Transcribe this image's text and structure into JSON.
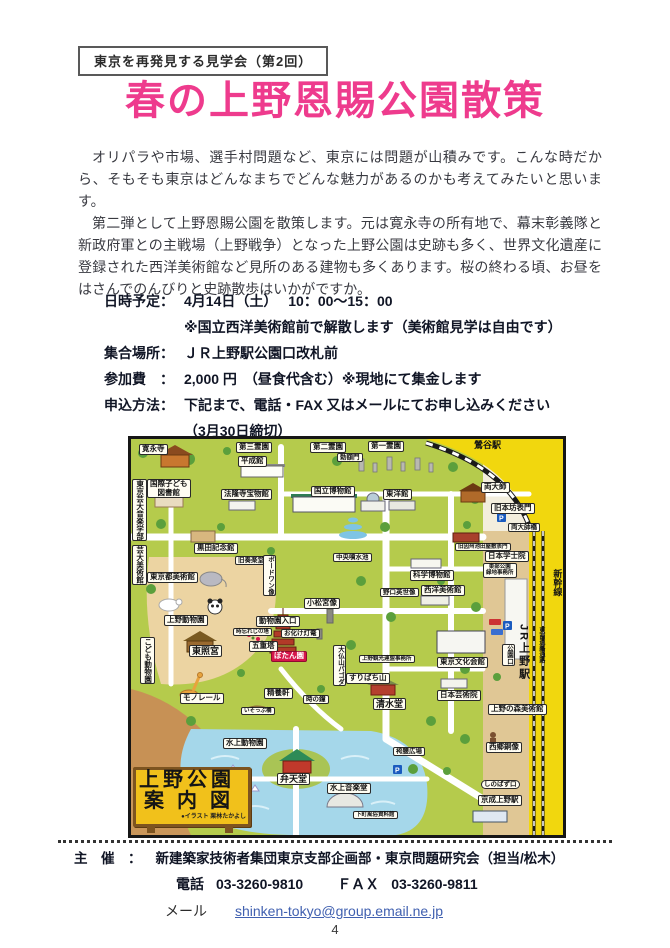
{
  "header": {
    "series_label": "東京を再発見する見学会（第2回）"
  },
  "title": "春の上野恩賜公園散策",
  "intro": {
    "p1": "オリパラや市場、選手村問題など、東京には問題が山積みです。こんな時だから、そもそも東京はどんなまちでどんな魅力があるのかも考えてみたいと思います。",
    "p2": "第二弾として上野恩賜公園を散策します。元は寛永寺の所有地で、幕末彰義隊と新政府軍との主戦場（上野戦争）となった上野公園は史跡も多く、世界文化遺産に登録された西洋美術館など見所のある建物も多くあります。桜の終わる頃、お昼をはさんでのんびりと史跡散歩はいかがですか。"
  },
  "details": {
    "rows": [
      {
        "label": "日時予定：",
        "value": "4月14日（土）　 10：00～15：00",
        "sub": "※国立西洋美術館前で解散します（美術館見学は自由です）"
      },
      {
        "label": "集合場所：",
        "value": "ＪＲ上野駅公園口改札前"
      },
      {
        "label": "参加費　：",
        "value": "2,000 円　（昼食代含む）※現地にて集金します"
      },
      {
        "label": "申込方法：",
        "value": "下記まで、電話・FAX 又はメールにてお申し込みください",
        "sub": "（3月30日締切）"
      }
    ]
  },
  "map": {
    "sign": {
      "line1": "上野公園",
      "line2": "案内図",
      "credit": "●イラスト 栗林たかよし"
    },
    "labels": [
      {
        "t": "寛永寺",
        "x": 8,
        "y": 5
      },
      {
        "t": "第三霊園",
        "x": 105,
        "y": 3
      },
      {
        "t": "第二霊園",
        "x": 179,
        "y": 3
      },
      {
        "t": "第一霊園",
        "x": 237,
        "y": 2
      },
      {
        "t": "鶯谷駅",
        "x": 341,
        "y": 1,
        "s": "plain"
      },
      {
        "t": "平成館",
        "x": 107,
        "y": 17
      },
      {
        "t": "勅額門",
        "x": 206,
        "y": 14,
        "s": "sm"
      },
      {
        "t": "国際子ども\n図書館",
        "x": 16,
        "y": 40
      },
      {
        "t": "法隆寺宝物館",
        "x": 90,
        "y": 50
      },
      {
        "t": "国立博物館",
        "x": 180,
        "y": 47
      },
      {
        "t": "東洋館",
        "x": 252,
        "y": 50
      },
      {
        "t": "両大師",
        "x": 350,
        "y": 43
      },
      {
        "t": "旧本坊表門",
        "x": 360,
        "y": 64
      },
      {
        "t": "両大師橋",
        "x": 377,
        "y": 84,
        "s": "sm"
      },
      {
        "t": "東京芸大音楽学部",
        "x": 1,
        "y": 40,
        "v": 1
      },
      {
        "t": "黒田記念館",
        "x": 63,
        "y": 104
      },
      {
        "t": "旧奏楽堂",
        "x": 104,
        "y": 117,
        "s": "sm"
      },
      {
        "t": "旧因州池田屋敷表門",
        "x": 324,
        "y": 104,
        "s": "tiny"
      },
      {
        "t": "日本学士院",
        "x": 354,
        "y": 112
      },
      {
        "t": "芸大美術館",
        "x": 1,
        "y": 106,
        "v": 1
      },
      {
        "t": "東京都美術館",
        "x": 16,
        "y": 133
      },
      {
        "t": "中央噴水池",
        "x": 202,
        "y": 114,
        "s": "sm"
      },
      {
        "t": "科学博物館",
        "x": 279,
        "y": 131
      },
      {
        "t": "野口英世像",
        "x": 249,
        "y": 149,
        "s": "sm"
      },
      {
        "t": "西洋美術館",
        "x": 290,
        "y": 146
      },
      {
        "t": "東部公園\n緑地事務所",
        "x": 352,
        "y": 124,
        "s": "tiny"
      },
      {
        "t": "新幹線",
        "x": 419,
        "y": 130,
        "v": 1,
        "s": "plain"
      },
      {
        "t": "ボードワン像",
        "x": 132,
        "y": 116,
        "v": 1,
        "s": "sm"
      },
      {
        "t": "小松宮像",
        "x": 173,
        "y": 159
      },
      {
        "t": "動物園入口",
        "x": 125,
        "y": 177
      },
      {
        "t": "上野動物園",
        "x": 33,
        "y": 176
      },
      {
        "t": "時忘れじの塔",
        "x": 102,
        "y": 189,
        "s": "tiny"
      },
      {
        "t": "お化け灯篭",
        "x": 150,
        "y": 190,
        "s": "sm"
      },
      {
        "t": "五重塔",
        "x": 118,
        "y": 202
      },
      {
        "t": "ぼたん園",
        "x": 140,
        "y": 212,
        "s": "red"
      },
      {
        "t": "東照宮",
        "x": 58,
        "y": 206,
        "s": "big"
      },
      {
        "t": "こども動物園",
        "x": 9,
        "y": 198,
        "v": 1
      },
      {
        "t": "大仏山パゴダ",
        "x": 202,
        "y": 206,
        "v": 1,
        "s": "sm"
      },
      {
        "t": "上野観光連盟事務所",
        "x": 228,
        "y": 216,
        "s": "tiny"
      },
      {
        "t": "すりばち山",
        "x": 215,
        "y": 234
      },
      {
        "t": "精養軒",
        "x": 133,
        "y": 249
      },
      {
        "t": "時の鐘",
        "x": 172,
        "y": 256,
        "s": "sm"
      },
      {
        "t": "モノレール",
        "x": 49,
        "y": 254
      },
      {
        "t": "いそっぷ橋",
        "x": 110,
        "y": 268,
        "s": "tiny"
      },
      {
        "t": "水上動物園",
        "x": 92,
        "y": 299
      },
      {
        "t": "清水堂",
        "x": 242,
        "y": 259,
        "s": "big"
      },
      {
        "t": "日本芸術院",
        "x": 306,
        "y": 251
      },
      {
        "t": "東京文化会館",
        "x": 306,
        "y": 218
      },
      {
        "t": "上野の森美術館",
        "x": 357,
        "y": 265
      },
      {
        "t": "西郷銅像",
        "x": 355,
        "y": 303
      },
      {
        "t": "しのばず口",
        "x": 350,
        "y": 341,
        "s": "bubble"
      },
      {
        "t": "京成上野駅",
        "x": 347,
        "y": 356
      },
      {
        "t": "弁天堂",
        "x": 146,
        "y": 334,
        "s": "big"
      },
      {
        "t": "水上音楽堂",
        "x": 196,
        "y": 344
      },
      {
        "t": "下町風俗資料館",
        "x": 222,
        "y": 372,
        "s": "tiny"
      },
      {
        "t": "袴腰広場",
        "x": 262,
        "y": 308,
        "s": "sm"
      },
      {
        "t": "JR上野駅",
        "x": 384,
        "y": 185,
        "v": 1,
        "s": "station"
      },
      {
        "t": "公園口",
        "x": 371,
        "y": 205,
        "v": 1,
        "s": "sm"
      },
      {
        "t": "東西連絡通路",
        "x": 404,
        "y": 188,
        "v": 1,
        "s": "plaintiny"
      }
    ]
  },
  "footer": {
    "organizer_label": "主　催　：",
    "organizer": "新建築家技術者集団東京支部企画部・東京問題研究会（担当/松木）",
    "tel_label": "電話",
    "tel": "03-3260-9810",
    "fax_label": "ＦＡＸ",
    "fax": "03-3260-9811",
    "email_label": "メール",
    "email": "shinken-tokyo@group.email.ne.jp"
  },
  "page_number": "4",
  "colors": {
    "title_pink": "#ee3b8d",
    "link_blue": "#4060b0",
    "map_green": "#b5cb4c",
    "map_yellow": "#f1d70e",
    "pond_blue": "#a5d7ea",
    "botan_red": "#d6164a",
    "sign_yellow": "#f1c11b"
  }
}
